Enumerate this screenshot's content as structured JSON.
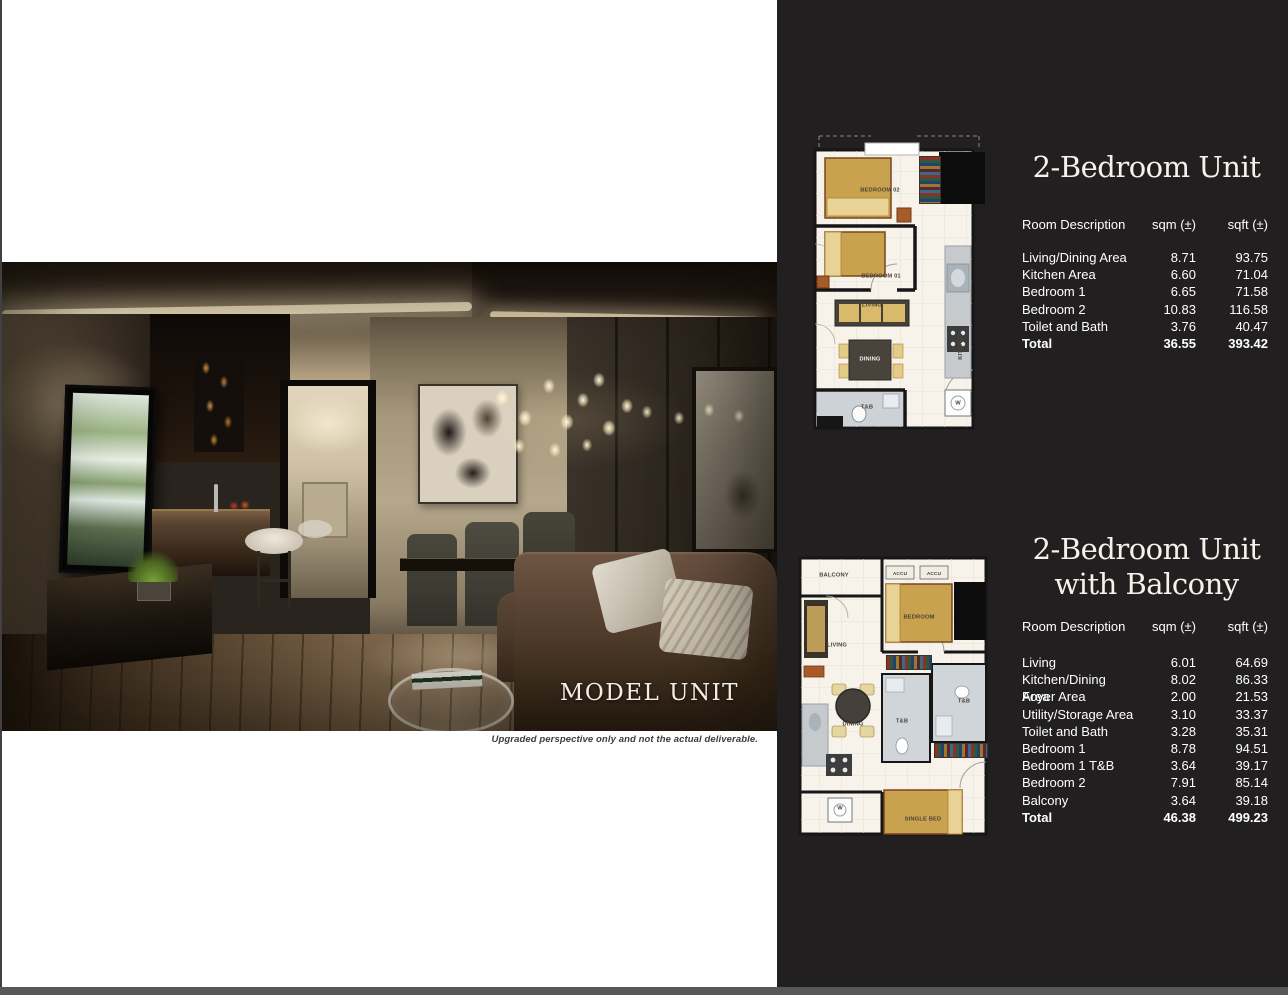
{
  "photo": {
    "caption": "MODEL UNIT",
    "disclaimer": "Upgraded perspective only and not the actual deliverable."
  },
  "unit1": {
    "title": "2-Bedroom Unit",
    "table": {
      "col_room": "Room Description",
      "col_sqm": "sqm (±)",
      "col_sqft": "sqft (±)",
      "rows": [
        {
          "room": "Living/Dining Area",
          "sqm": "8.71",
          "sqft": "93.75"
        },
        {
          "room": "Kitchen Area",
          "sqm": "6.60",
          "sqft": "71.04"
        },
        {
          "room": "Bedroom 1",
          "sqm": "6.65",
          "sqft": "71.58"
        },
        {
          "room": "Bedroom 2",
          "sqm": "10.83",
          "sqft": "116.58"
        },
        {
          "room": "Toilet and Bath",
          "sqm": "3.76",
          "sqft": "40.47"
        },
        {
          "room": "Total",
          "sqm": "36.55",
          "sqft": "393.42"
        }
      ]
    },
    "plan": {
      "bedroom2": "BEDROOM 02",
      "bedroom1": "BEDROOM 01",
      "living": "LIVING",
      "dining": "DINING",
      "toilet": "T&B",
      "kitchen": "KITCHEN",
      "washer": "W"
    }
  },
  "unit2": {
    "title_line1": "2-Bedroom Unit",
    "title_line2": "with Balcony",
    "table": {
      "col_room": "Room Description",
      "col_sqm": "sqm (±)",
      "col_sqft": "sqft (±)",
      "rows": [
        {
          "room": "Living",
          "sqm": "6.01",
          "sqft": "64.69"
        },
        {
          "room": "Kitchen/Dining Area",
          "sqm": "8.02",
          "sqft": "86.33"
        },
        {
          "room": "Foyer Area",
          "sqm": "2.00",
          "sqft": "21.53"
        },
        {
          "room": "Utility/Storage Area",
          "sqm": "3.10",
          "sqft": "33.37"
        },
        {
          "room": "Toilet and Bath",
          "sqm": "3.28",
          "sqft": "35.31"
        },
        {
          "room": "Bedroom 1",
          "sqm": "8.78",
          "sqft": "94.51"
        },
        {
          "room": "Bedroom 1 T&B",
          "sqm": "3.64",
          "sqft": "39.17"
        },
        {
          "room": "Bedroom 2",
          "sqm": "7.91",
          "sqft": "85.14"
        },
        {
          "room": "Balcony",
          "sqm": "3.64",
          "sqft": "39.18"
        },
        {
          "room": "Total",
          "sqm": "46.38",
          "sqft": "499.23"
        }
      ]
    },
    "plan": {
      "balcony": "BALCONY",
      "accu1": "ACCU",
      "accu2": "ACCU",
      "bedroom": "BEDROOM",
      "living": "LIVING",
      "dining": "DINING",
      "toilet1": "T&B",
      "toilet2": "T&B",
      "single_bed": "SINGLE BED",
      "washer": "W"
    }
  },
  "colors": {
    "panel_bg": "#221F20",
    "bottom_bar": "#58585A",
    "title_text": "#F5F2EB",
    "table_text": "#FFFFFF",
    "plan_paper": "#F7F3EA",
    "plan_wall": "#161616",
    "plan_wood": "#C9A24F",
    "plan_accent_orange": "#A85A28",
    "disclaimer_text": "#3C3C3C"
  }
}
